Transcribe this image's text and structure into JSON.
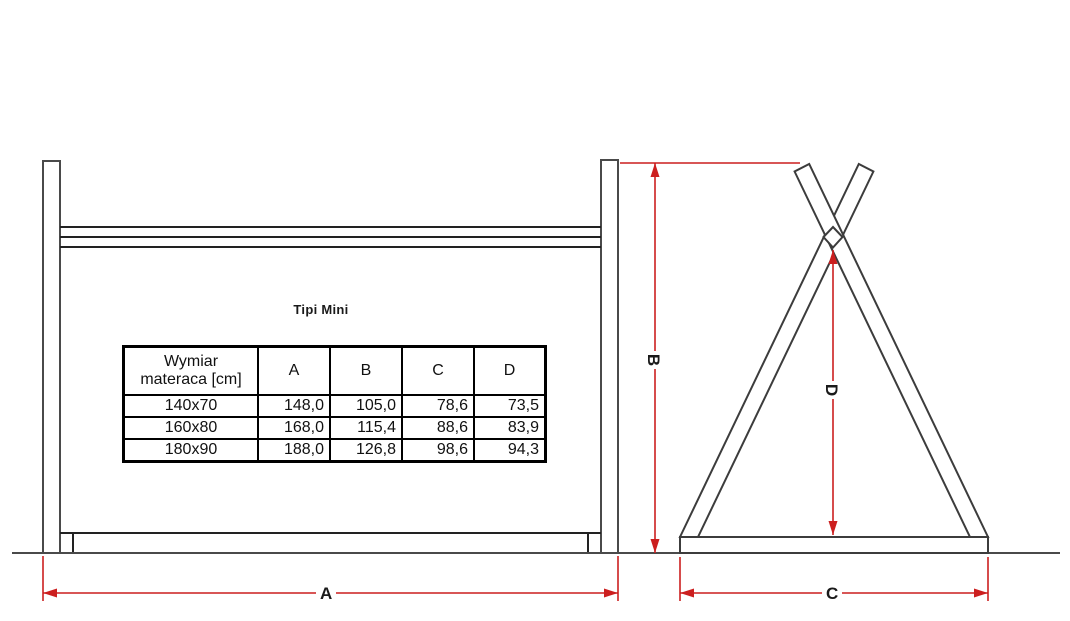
{
  "title": "Tipi Mini",
  "table": {
    "size_header": {
      "line1": "Wymiar",
      "line2": "materaca [cm]"
    },
    "col_headers": [
      "A",
      "B",
      "C",
      "D"
    ],
    "rows": [
      {
        "size": "140x70",
        "a": "148,0",
        "b": "105,0",
        "c": "78,6",
        "d": "73,5"
      },
      {
        "size": "160x80",
        "a": "168,0",
        "b": "115,4",
        "c": "88,6",
        "d": "83,9"
      },
      {
        "size": "180x90",
        "a": "188,0",
        "b": "126,8",
        "c": "98,6",
        "d": "94,3"
      }
    ]
  },
  "dimension_labels": {
    "a": "A",
    "b": "B",
    "c": "C",
    "d": "D"
  },
  "colors": {
    "dimension_red": "#cc1f1f",
    "structure_line": "#3c3c3c",
    "table_border": "#000000"
  }
}
